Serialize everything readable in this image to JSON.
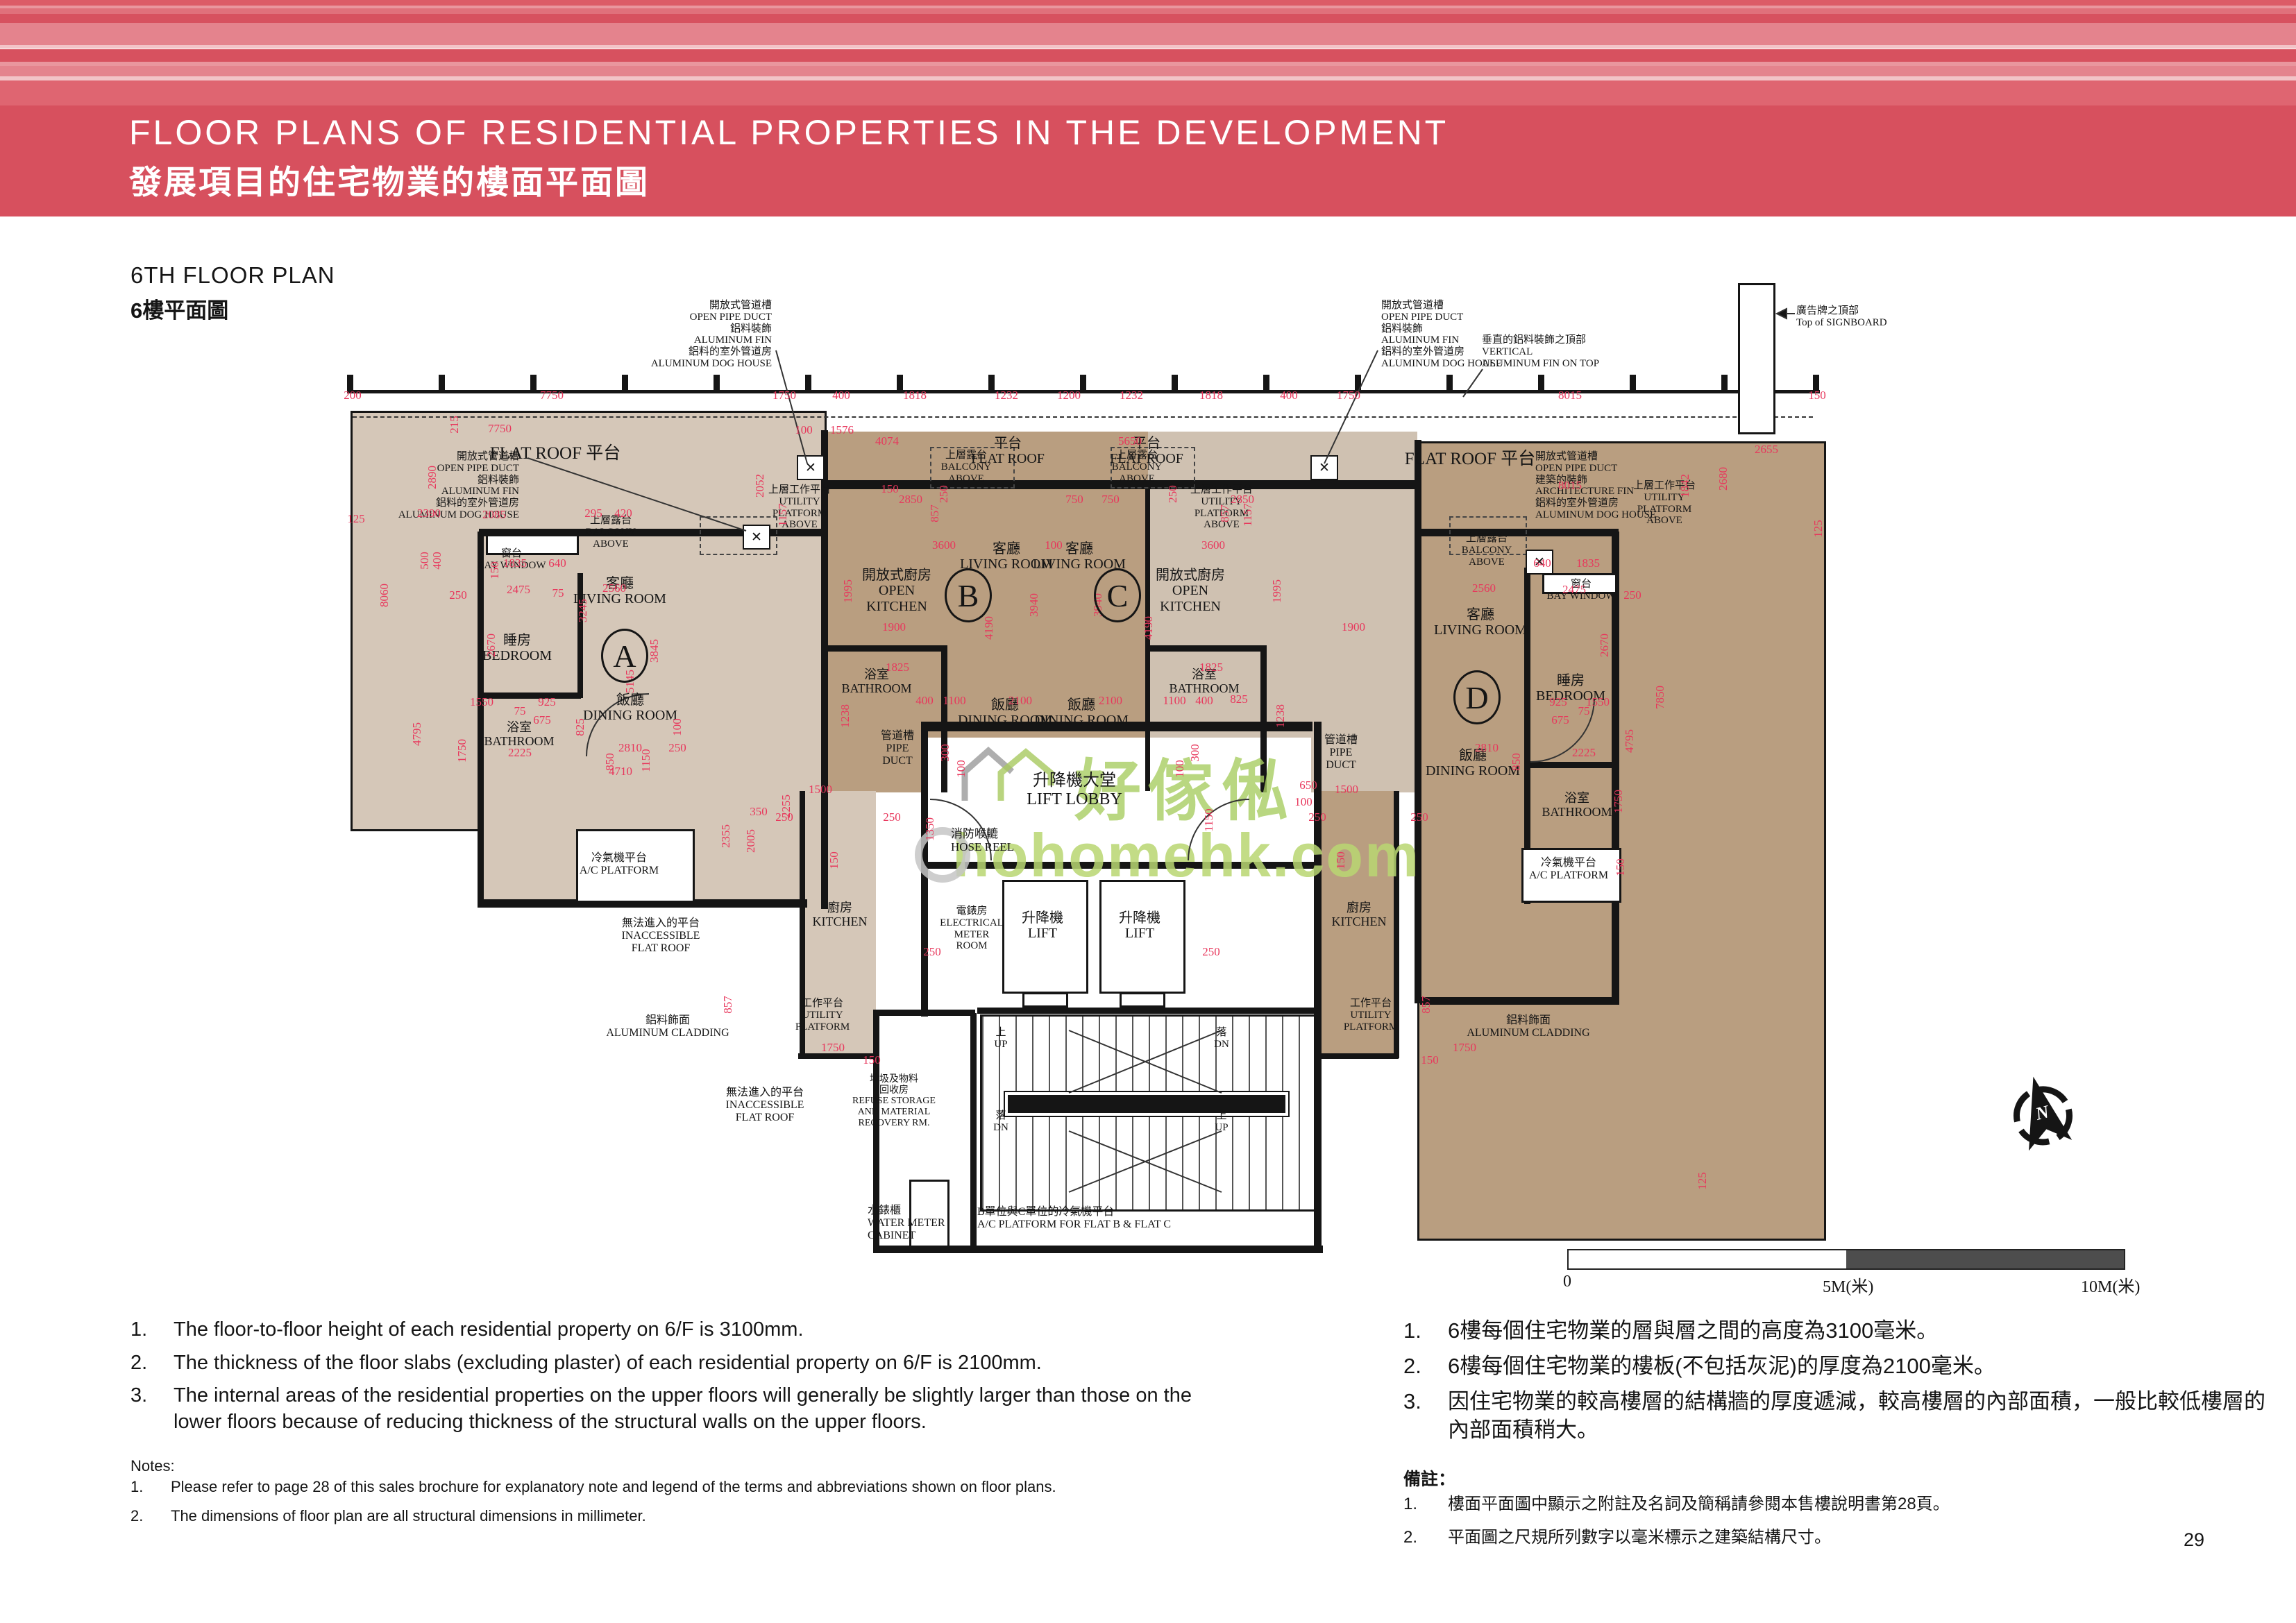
{
  "header": {
    "title_en": "FLOOR PLANS OF RESIDENTIAL PROPERTIES IN THE DEVELOPMENT",
    "title_zh": "發展項目的住宅物業的樓面平面圖"
  },
  "section": {
    "title_en": "6TH FLOOR PLAN",
    "title_zh": "6樓平面圖"
  },
  "colors": {
    "accent": "#d7505e",
    "plan_light": "#d5c7b8",
    "plan_dark": "#b99e80",
    "dim_red": "#e8375c",
    "watermark_green": "#b5d36d"
  },
  "watermark": {
    "brand": "好傢俬",
    "domain": "hohomehk.com"
  },
  "north_label": "N",
  "scalebar": {
    "zero": "0",
    "mid": "5M(米)",
    "end": "10M(米)"
  },
  "page_number": "29",
  "plan": {
    "units": [
      [
        "A",
        900,
        945
      ],
      [
        "B",
        1395,
        858
      ],
      [
        "C",
        1610,
        858
      ],
      [
        "D",
        2128,
        1005
      ]
    ],
    "labels": [
      [
        "FLAT ROOF  平台",
        800,
        640,
        25,
        "c"
      ],
      [
        "平台\nFLAT ROOF",
        1452,
        628,
        20,
        "c"
      ],
      [
        "平台\nFLAT ROOF",
        1652,
        628,
        20,
        "c"
      ],
      [
        "FLAT ROOF  平台",
        2118,
        648,
        25,
        "c"
      ],
      [
        "上層露台\nBALCONY\nABOVE",
        1392,
        648,
        15,
        "c"
      ],
      [
        "上層露台\nBALCONY\nABOVE",
        1638,
        648,
        15,
        "c"
      ],
      [
        "上層露台\nBALCONY\nABOVE",
        880,
        742,
        15,
        "c"
      ],
      [
        "上層露台\nBALCONY\nABOVE",
        2142,
        768,
        15,
        "c"
      ],
      [
        "上層工作平台\nUTILITY\nPLATFORM\nABOVE",
        1152,
        698,
        15,
        "c"
      ],
      [
        "上層工作平台\nUTILITY\nPLATFORM\nABOVE",
        1760,
        698,
        15,
        "c"
      ],
      [
        "上層工作平台\nUTILITY\nPLATFORM\nABOVE",
        2398,
        692,
        15,
        "c"
      ],
      [
        "窗台\nBAY WINDOW",
        737,
        790,
        15,
        "c"
      ],
      [
        "窗台\nBAY WINDOW",
        2278,
        834,
        15,
        "c"
      ],
      [
        "客廳\nLIVING ROOM",
        893,
        830,
        20,
        "c"
      ],
      [
        "客廳\nLIVING ROOM",
        1450,
        780,
        20,
        "c"
      ],
      [
        "客廳\nLIVING ROOM",
        1555,
        780,
        20,
        "c"
      ],
      [
        "客廳\nLIVING ROOM",
        2133,
        875,
        20,
        "c"
      ],
      [
        "開放式廚房\nOPEN\nKITCHEN",
        1292,
        818,
        20,
        "c"
      ],
      [
        "開放式廚房\nOPEN\nKITCHEN",
        1715,
        818,
        20,
        "c"
      ],
      [
        "睡房\nBEDROOM",
        745,
        912,
        20,
        "c"
      ],
      [
        "睡房\nBEDROOM",
        2263,
        970,
        20,
        "c"
      ],
      [
        "浴室\nBATHROOM",
        748,
        1038,
        18,
        "c"
      ],
      [
        "浴室\nBATHROOM",
        1263,
        962,
        18,
        "c"
      ],
      [
        "浴室\nBATHROOM",
        1735,
        962,
        18,
        "c"
      ],
      [
        "浴室\nBATHROOM",
        2272,
        1140,
        18,
        "c"
      ],
      [
        "飯廳\nDINING ROOM",
        908,
        998,
        20,
        "c"
      ],
      [
        "飯廳\nDINING ROOM",
        1448,
        1005,
        20,
        "c"
      ],
      [
        "飯廳\nDINING ROOM",
        1558,
        1005,
        20,
        "c"
      ],
      [
        "飯廳\nDINING ROOM",
        2122,
        1078,
        20,
        "c"
      ],
      [
        "管道槽\nPIPE\nDUCT",
        1293,
        1052,
        16,
        "c"
      ],
      [
        "管道槽\nPIPE\nDUCT",
        1932,
        1058,
        16,
        "c"
      ],
      [
        "升降機大堂\nLIFT LOBBY",
        1548,
        1112,
        24,
        "c"
      ],
      [
        "消防喉轆\nHOSE REEL",
        1370,
        1192,
        17,
        "l"
      ],
      [
        "電錶房\nELECTRICAL\nMETER\nROOM",
        1400,
        1305,
        15,
        "c"
      ],
      [
        "升降機\nLIFT",
        1502,
        1312,
        20,
        "c"
      ],
      [
        "升降機\nLIFT",
        1642,
        1312,
        20,
        "c"
      ],
      [
        "廚房\nKITCHEN",
        1210,
        1298,
        18,
        "c"
      ],
      [
        "廚房\nKITCHEN",
        1958,
        1298,
        18,
        "c"
      ],
      [
        "工作平台\nUTILITY\nPLATFORM",
        1185,
        1438,
        15,
        "c"
      ],
      [
        "工作平台\nUTILITY\nPLATFORM",
        1975,
        1438,
        15,
        "c"
      ],
      [
        "冷氣機平台\nA/C PLATFORM",
        892,
        1228,
        16,
        "c"
      ],
      [
        "冷氣機平台\nA/C PLATFORM",
        2260,
        1235,
        16,
        "c"
      ],
      [
        "垃圾及物料\n回收房\nREFUSE STORAGE\nAND MATERIAL\nRECOVERY RM.",
        1288,
        1548,
        14,
        "c"
      ],
      [
        "上\nUP",
        1442,
        1480,
        15,
        "c"
      ],
      [
        "落\nDN",
        1760,
        1480,
        15,
        "c"
      ],
      [
        "落\nDN",
        1442,
        1600,
        15,
        "c"
      ],
      [
        "上\nUP",
        1760,
        1600,
        15,
        "c"
      ],
      [
        "水錶櫃\nWATER METER\nCABINET",
        1250,
        1736,
        16,
        "l"
      ],
      [
        "B單位與C單位的冷氣機平台\nA/C PLATFORM FOR FLAT B & FLAT C",
        1408,
        1738,
        16,
        "l"
      ],
      [
        "無法進入的平台\nINACCESSIBLE\nFLAT ROOF",
        952,
        1322,
        16,
        "c"
      ],
      [
        "鋁料飾面\nALUMINUM CLADDING",
        962,
        1462,
        16,
        "c"
      ],
      [
        "無法進入的平台\nINACCESSIBLE\nFLAT ROOF",
        1102,
        1566,
        16,
        "c"
      ],
      [
        "鋁料飾面\nALUMINUM CLADDING",
        2202,
        1462,
        16,
        "c"
      ],
      [
        "開放式管道槽\nOPEN PIPE DUCT\n鋁料裝飾\nALUMINUM FIN\n鋁料的室外管道房\nALUMINUM DOG HOUSE",
        1112,
        432,
        15,
        "r"
      ],
      [
        "開放式管道槽\nOPEN PIPE DUCT\n鋁料裝飾\nALUMINUM FIN\n鋁料的室外管道房\nALUMINUM DOG HOUSE",
        748,
        650,
        15,
        "r"
      ],
      [
        "開放式管道槽\nOPEN PIPE DUCT\n鋁料裝飾\nALUMINUM FIN\n鋁料的室外管道房\nALUMINUM DOG HOUSE",
        1990,
        432,
        15,
        "l"
      ],
      [
        "開放式管道槽\nOPEN PIPE DUCT\n建築的裝飾\nARCHITECTURE FIN\n鋁料的室外管道房\nALUMINUM DOG HOUSE",
        2212,
        650,
        15,
        "l"
      ],
      [
        "垂直的鋁料裝飾之頂部\nVERTICAL\nALUMINUM FIN ON TOP",
        2135,
        482,
        15,
        "l"
      ],
      [
        "廣告牌之頂部\nTop of SIGNBOARD",
        2588,
        440,
        15,
        "l"
      ]
    ],
    "dims": [
      [
        "200",
        508,
        570
      ],
      [
        "7750",
        795,
        570
      ],
      [
        "1750",
        1130,
        570
      ],
      [
        "400",
        1212,
        570
      ],
      [
        "1818",
        1318,
        570
      ],
      [
        "1232",
        1450,
        570
      ],
      [
        "1200",
        1540,
        570
      ],
      [
        "1232",
        1630,
        570
      ],
      [
        "1818",
        1745,
        570
      ],
      [
        "400",
        1857,
        570
      ],
      [
        "1750",
        1943,
        570
      ],
      [
        "8015",
        2262,
        570
      ],
      [
        "150",
        2618,
        570
      ],
      [
        "7750",
        720,
        618
      ],
      [
        "100",
        1158,
        620
      ],
      [
        "1576",
        1213,
        620
      ],
      [
        "8015",
        2262,
        700
      ],
      [
        "2655",
        2545,
        648
      ],
      [
        "215",
        655,
        612,
        1
      ],
      [
        "2680",
        2483,
        690,
        1
      ],
      [
        "125",
        2620,
        762,
        1
      ],
      [
        "2052",
        1095,
        700,
        1
      ],
      [
        "1842",
        2428,
        700,
        1
      ],
      [
        "125",
        513,
        748
      ],
      [
        "2390",
        618,
        740
      ],
      [
        "2085",
        712,
        742
      ],
      [
        "295",
        855,
        740
      ],
      [
        "420",
        898,
        740
      ],
      [
        "2890",
        623,
        688,
        1
      ],
      [
        "8060",
        554,
        858,
        1
      ],
      [
        "4795",
        601,
        1058,
        1
      ],
      [
        "250",
        660,
        858
      ],
      [
        "150",
        713,
        822,
        1
      ],
      [
        "500",
        612,
        808,
        1
      ],
      [
        "400",
        630,
        808,
        1
      ],
      [
        "1835",
        742,
        812
      ],
      [
        "640",
        803,
        812
      ],
      [
        "2475",
        747,
        850
      ],
      [
        "2560",
        885,
        848
      ],
      [
        "75",
        804,
        855
      ],
      [
        "3245",
        840,
        880,
        1
      ],
      [
        "3845",
        943,
        938,
        1
      ],
      [
        "5145",
        908,
        982,
        1
      ],
      [
        "2670",
        708,
        930,
        1
      ],
      [
        "1550",
        694,
        1012
      ],
      [
        "925",
        788,
        1012
      ],
      [
        "75",
        749,
        1025
      ],
      [
        "675",
        781,
        1038
      ],
      [
        "825",
        836,
        1048,
        1
      ],
      [
        "1750",
        666,
        1082,
        1
      ],
      [
        "2225",
        749,
        1085
      ],
      [
        "2810",
        908,
        1078
      ],
      [
        "1150",
        931,
        1096,
        1
      ],
      [
        "250",
        976,
        1078
      ],
      [
        "850",
        879,
        1098,
        1
      ],
      [
        "4710",
        894,
        1112
      ],
      [
        "100",
        976,
        1048,
        1
      ],
      [
        "4074",
        1278,
        636
      ],
      [
        "5650",
        1628,
        636
      ],
      [
        "2850",
        1312,
        720
      ],
      [
        "750",
        1548,
        720
      ],
      [
        "750",
        1600,
        720
      ],
      [
        "2850",
        1790,
        720
      ],
      [
        "857",
        1347,
        740,
        1
      ],
      [
        "857",
        1765,
        740,
        1
      ],
      [
        "1157",
        1128,
        742,
        1
      ],
      [
        "1157",
        1798,
        742,
        1
      ],
      [
        "150",
        1282,
        705
      ],
      [
        "250",
        1360,
        712,
        1
      ],
      [
        "250",
        1690,
        712,
        1
      ],
      [
        "3600",
        1360,
        786
      ],
      [
        "100",
        1518,
        786
      ],
      [
        "3600",
        1748,
        786
      ],
      [
        "1995",
        1222,
        852,
        1
      ],
      [
        "1995",
        1840,
        852,
        1
      ],
      [
        "3940",
        1490,
        872,
        1
      ],
      [
        "3940",
        1582,
        872,
        1
      ],
      [
        "4190",
        1425,
        905,
        1
      ],
      [
        "4190",
        1655,
        905,
        1
      ],
      [
        "1900",
        1288,
        904
      ],
      [
        "1900",
        1950,
        904
      ],
      [
        "1825",
        1293,
        962
      ],
      [
        "1825",
        1745,
        962
      ],
      [
        "1238",
        1218,
        1032,
        1
      ],
      [
        "1238",
        1845,
        1032,
        1
      ],
      [
        "400",
        1332,
        1010
      ],
      [
        "1100",
        1375,
        1010
      ],
      [
        "2100",
        1470,
        1010
      ],
      [
        "2100",
        1600,
        1010
      ],
      [
        "1100",
        1692,
        1010
      ],
      [
        "400",
        1735,
        1010
      ],
      [
        "825",
        1785,
        1008
      ],
      [
        "300",
        1362,
        1085,
        1
      ],
      [
        "300",
        1722,
        1085,
        1
      ],
      [
        "100",
        1385,
        1108,
        1
      ],
      [
        "100",
        1700,
        1108,
        1
      ],
      [
        "1350",
        1340,
        1195,
        1
      ],
      [
        "1150",
        1742,
        1182,
        1
      ],
      [
        "650",
        1885,
        1132
      ],
      [
        "100",
        1878,
        1156
      ],
      [
        "1500",
        1182,
        1138
      ],
      [
        "250",
        1130,
        1178
      ],
      [
        "250",
        1285,
        1178
      ],
      [
        "150",
        1202,
        1240,
        1
      ],
      [
        "1500",
        1940,
        1138
      ],
      [
        "250",
        1898,
        1178
      ],
      [
        "250",
        2045,
        1178
      ],
      [
        "150",
        1932,
        1240,
        1
      ],
      [
        "2355",
        1046,
        1205,
        1
      ],
      [
        "2005",
        1082,
        1212,
        1
      ],
      [
        "350",
        1093,
        1170
      ],
      [
        "2255",
        1133,
        1162,
        1
      ],
      [
        "857",
        1049,
        1448,
        1
      ],
      [
        "857",
        2055,
        1448,
        1
      ],
      [
        "1750",
        1200,
        1510
      ],
      [
        "150",
        1256,
        1528
      ],
      [
        "1750",
        2110,
        1510
      ],
      [
        "150",
        2060,
        1528
      ],
      [
        "250",
        1343,
        1372
      ],
      [
        "250",
        1745,
        1372
      ],
      [
        "640",
        2222,
        812
      ],
      [
        "1835",
        2288,
        812
      ],
      [
        "2475",
        2268,
        850
      ],
      [
        "2560",
        2138,
        848
      ],
      [
        "250",
        2352,
        858
      ],
      [
        "2670",
        2312,
        930,
        1
      ],
      [
        "925",
        2245,
        1012
      ],
      [
        "1550",
        2302,
        1012
      ],
      [
        "75",
        2282,
        1025
      ],
      [
        "675",
        2248,
        1038
      ],
      [
        "2225",
        2282,
        1085
      ],
      [
        "2810",
        2142,
        1078
      ],
      [
        "850",
        2185,
        1098,
        1
      ],
      [
        "7850",
        2392,
        1005,
        1
      ],
      [
        "4795",
        2348,
        1068,
        1
      ],
      [
        "125",
        2453,
        1702,
        1
      ],
      [
        "1750",
        2332,
        1155,
        1
      ],
      [
        "150",
        2335,
        1250,
        1
      ]
    ]
  },
  "notes_en": {
    "nums": [
      "1.",
      "2.",
      "3."
    ],
    "items": [
      "The floor-to-floor height of each residential property on 6/F is 3100mm.",
      "The thickness of the floor slabs (excluding plaster) of each residential property on 6/F is 2100mm.",
      "The internal areas of the residential properties on the upper floors will generally be slightly larger than those on the lower floors because of reducing thickness of the structural walls on the upper floors."
    ],
    "label": "Notes:",
    "small_nums": [
      "1.",
      "2."
    ],
    "small_items": [
      "Please refer to page 28 of this sales brochure for explanatory note and legend of the terms and abbreviations shown on floor plans.",
      "The dimensions of floor plan are all structural dimensions in millimeter."
    ]
  },
  "notes_zh": {
    "nums": [
      "1.",
      "2.",
      "3."
    ],
    "items": [
      "6樓每個住宅物業的層與層之間的高度為3100毫米。",
      "6樓每個住宅物業的樓板(不包括灰泥)的厚度為2100毫米。",
      "因住宅物業的較高樓層的結構牆的厚度遞減，較高樓層的內部面積，一般比較低樓層的內部面積稍大。"
    ],
    "label": "備註：",
    "small_nums": [
      "1.",
      "2."
    ],
    "small_items": [
      "樓面平面圖中顯示之附註及名詞及簡稱請參閱本售樓說明書第28頁。",
      "平面圖之尺規所列數字以毫米標示之建築結構尺寸。"
    ]
  }
}
